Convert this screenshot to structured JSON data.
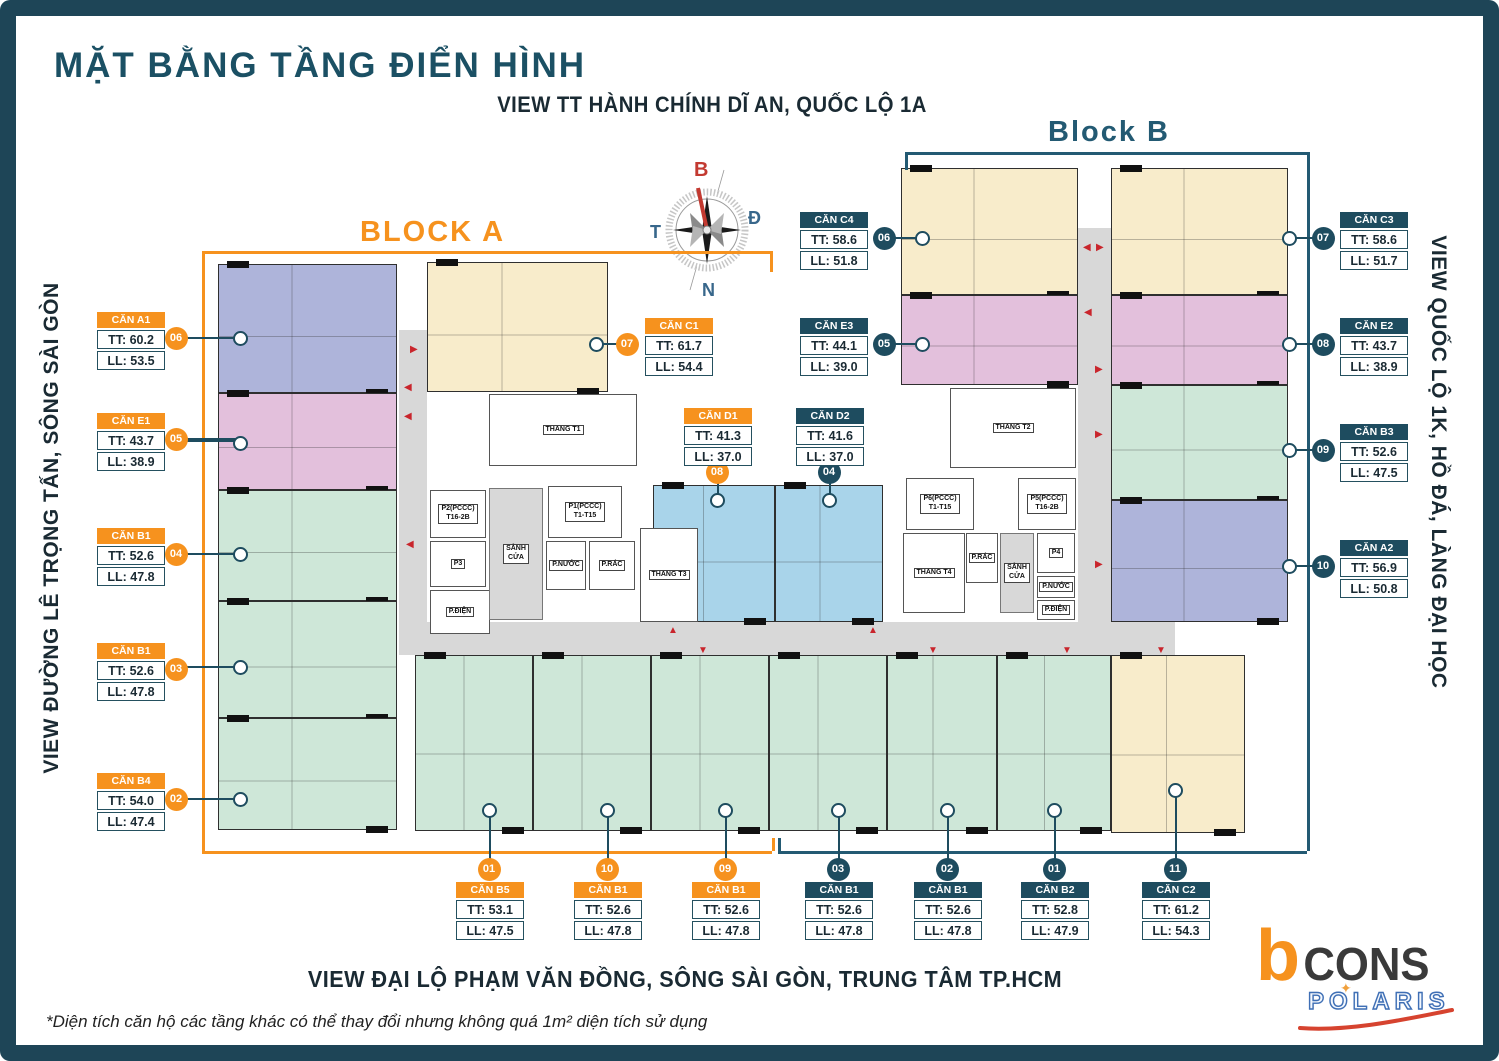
{
  "meta": {
    "title": "MẶT BẰNG TẦNG ĐIỂN HÌNH",
    "subtitle_top": "VIEW TT HÀNH CHÍNH DĨ AN, QUỐC LỘ 1A",
    "block_a": "BLOCK A",
    "block_b": "Block B",
    "view_left": "VIEW ĐƯỜNG LÊ TRỌNG TẤN, SÔNG SÀI GÒN",
    "view_right": "VIEW QUỐC LỘ 1K, HỒ ĐÁ, LÀNG ĐẠI HỌC",
    "view_bottom": "VIEW ĐẠI LỘ PHẠM VĂN ĐỒNG, SÔNG SÀI GÒN, TRUNG TÂM TP.HCM",
    "footnote": "*Diện tích căn hộ các tầng khác có thể thay đổi nhưng không quá 1m² diện tích sử dụng"
  },
  "compass": {
    "n": "B",
    "e": "Đ",
    "w": "T",
    "s": "N"
  },
  "logo": {
    "b": "b",
    "cons": "CONS",
    "polaris": "POLARIS",
    "star": "✦"
  },
  "palette": {
    "orange": "#F6921E",
    "teal": "#1E4C5F",
    "frame": "#1E4557",
    "purple": "#AEB4DA",
    "pink": "#E3C0DC",
    "green": "#CEE7D8",
    "cream": "#F8ECCB",
    "blue": "#A9D4EA",
    "corridor": "#D8D8D8",
    "red": "#C9252C"
  },
  "floorplan": {
    "units": [
      {
        "id": "A1",
        "type": "purple",
        "x": 218,
        "y": 264,
        "w": 179,
        "h": 129
      },
      {
        "id": "E1",
        "type": "pink",
        "x": 218,
        "y": 393,
        "w": 179,
        "h": 97
      },
      {
        "id": "B1-04",
        "type": "green",
        "x": 218,
        "y": 490,
        "w": 179,
        "h": 111
      },
      {
        "id": "B1-03",
        "type": "green",
        "x": 218,
        "y": 601,
        "w": 179,
        "h": 117
      },
      {
        "id": "B4-02",
        "type": "green",
        "x": 218,
        "y": 718,
        "w": 179,
        "h": 112
      },
      {
        "id": "C1",
        "type": "cream",
        "x": 427,
        "y": 262,
        "w": 181,
        "h": 130
      },
      {
        "id": "D1",
        "type": "blue",
        "x": 653,
        "y": 485,
        "w": 122,
        "h": 137
      },
      {
        "id": "D2",
        "type": "blue",
        "x": 775,
        "y": 485,
        "w": 108,
        "h": 137
      },
      {
        "id": "C4",
        "type": "cream",
        "x": 901,
        "y": 168,
        "w": 177,
        "h": 127
      },
      {
        "id": "C3",
        "type": "cream",
        "x": 1111,
        "y": 168,
        "w": 177,
        "h": 127
      },
      {
        "id": "E3",
        "type": "pink",
        "x": 901,
        "y": 295,
        "w": 177,
        "h": 90
      },
      {
        "id": "E2",
        "type": "pink",
        "x": 1111,
        "y": 295,
        "w": 177,
        "h": 90
      },
      {
        "id": "B3",
        "type": "green",
        "x": 1111,
        "y": 385,
        "w": 177,
        "h": 115
      },
      {
        "id": "A2",
        "type": "purple",
        "x": 1111,
        "y": 500,
        "w": 177,
        "h": 122
      },
      {
        "id": "B5",
        "type": "green",
        "x": 415,
        "y": 655,
        "w": 118,
        "h": 176
      },
      {
        "id": "B1-10",
        "type": "green",
        "x": 533,
        "y": 655,
        "w": 118,
        "h": 176
      },
      {
        "id": "B1-09",
        "type": "green",
        "x": 651,
        "y": 655,
        "w": 118,
        "h": 176
      },
      {
        "id": "B1-03b",
        "type": "green",
        "x": 769,
        "y": 655,
        "w": 118,
        "h": 176
      },
      {
        "id": "B1-02b",
        "type": "green",
        "x": 887,
        "y": 655,
        "w": 110,
        "h": 176
      },
      {
        "id": "B2",
        "type": "green",
        "x": 997,
        "y": 655,
        "w": 114,
        "h": 176
      },
      {
        "id": "C2",
        "type": "cream",
        "x": 1111,
        "y": 655,
        "w": 134,
        "h": 178
      }
    ],
    "corridors": [
      {
        "x": 399,
        "y": 330,
        "w": 28,
        "h": 325
      },
      {
        "x": 1078,
        "y": 228,
        "w": 33,
        "h": 427
      },
      {
        "x": 399,
        "y": 622,
        "w": 776,
        "h": 33
      }
    ],
    "rooms": [
      {
        "k": "stairs",
        "x": 489,
        "y": 394,
        "w": 148,
        "h": 72,
        "label": "THANG T1"
      },
      {
        "k": "lift",
        "x": 430,
        "y": 490,
        "w": 56,
        "h": 48,
        "label": "P2(PCCC)\nT16-2B"
      },
      {
        "k": "lift",
        "x": 548,
        "y": 486,
        "w": 74,
        "h": 52,
        "label": "P1(PCCC)\nT1-T15"
      },
      {
        "k": "lift",
        "x": 430,
        "y": 541,
        "w": 56,
        "h": 46,
        "label": "P3"
      },
      {
        "k": "room",
        "x": 430,
        "y": 590,
        "w": 60,
        "h": 44,
        "label": "P.ĐIỆN"
      },
      {
        "k": "lobby",
        "x": 489,
        "y": 488,
        "w": 54,
        "h": 132,
        "label": "SẢNH\nCỬA"
      },
      {
        "k": "room",
        "x": 546,
        "y": 541,
        "w": 40,
        "h": 49,
        "label": "P.NƯỚC"
      },
      {
        "k": "room",
        "x": 589,
        "y": 541,
        "w": 46,
        "h": 49,
        "label": "P.RÁC"
      },
      {
        "k": "stairs",
        "x": 640,
        "y": 528,
        "w": 58,
        "h": 94,
        "label": "THANG T3"
      },
      {
        "k": "stairs",
        "x": 950,
        "y": 388,
        "w": 126,
        "h": 80,
        "label": "THANG T2"
      },
      {
        "k": "lift",
        "x": 906,
        "y": 478,
        "w": 68,
        "h": 52,
        "label": "P6(PCCC)\nT1-T15"
      },
      {
        "k": "lift",
        "x": 1018,
        "y": 478,
        "w": 58,
        "h": 52,
        "label": "P5(PCCC)\nT16-2B"
      },
      {
        "k": "stairs",
        "x": 903,
        "y": 533,
        "w": 62,
        "h": 80,
        "label": "THANG T4"
      },
      {
        "k": "room",
        "x": 966,
        "y": 533,
        "w": 32,
        "h": 50,
        "label": "P.RÁC"
      },
      {
        "k": "lobby",
        "x": 1000,
        "y": 533,
        "w": 34,
        "h": 80,
        "label": "SẢNH\nCỬA"
      },
      {
        "k": "room",
        "x": 1037,
        "y": 533,
        "w": 38,
        "h": 40,
        "label": "P4"
      },
      {
        "k": "room",
        "x": 1037,
        "y": 576,
        "w": 38,
        "h": 22,
        "label": "P.NƯỚC"
      },
      {
        "k": "room",
        "x": 1037,
        "y": 600,
        "w": 38,
        "h": 20,
        "label": "P.ĐIỆN"
      }
    ],
    "arrows": [
      [
        410,
        345,
        "▶"
      ],
      [
        404,
        383,
        "◀"
      ],
      [
        404,
        412,
        "◀"
      ],
      [
        406,
        540,
        "◀"
      ],
      [
        1083,
        243,
        "◀"
      ],
      [
        1096,
        243,
        "▶"
      ],
      [
        1084,
        308,
        "◀"
      ],
      [
        1095,
        365,
        "▶"
      ],
      [
        1095,
        430,
        "▶"
      ],
      [
        1095,
        560,
        "▶"
      ],
      [
        668,
        626,
        "▲"
      ],
      [
        868,
        626,
        "▲"
      ],
      [
        698,
        646,
        "▼"
      ],
      [
        928,
        646,
        "▼"
      ],
      [
        1062,
        646,
        "▼"
      ],
      [
        1156,
        646,
        "▼"
      ]
    ],
    "brackets": [
      {
        "color": "#F6921E",
        "segs": [
          [
            202,
            251,
            770,
            251
          ],
          [
            770,
            251,
            770,
            272
          ],
          [
            202,
            251,
            202,
            851
          ],
          [
            202,
            851,
            772,
            851
          ],
          [
            772,
            838,
            772,
            851
          ]
        ]
      },
      {
        "color": "#235A73",
        "segs": [
          [
            905,
            152,
            1307,
            152
          ],
          [
            905,
            152,
            905,
            170
          ],
          [
            1307,
            152,
            1307,
            851
          ],
          [
            778,
            851,
            1307,
            851
          ],
          [
            778,
            838,
            778,
            851
          ]
        ]
      }
    ]
  },
  "callouts": [
    {
      "name": "CĂN A1",
      "tt": "TT: 60.2",
      "ll": "LL: 53.5",
      "badge": "06",
      "scheme": "orange",
      "box": [
        97,
        312
      ],
      "badge_c": [
        176,
        338
      ],
      "marker": [
        240,
        338
      ]
    },
    {
      "name": "CĂN E1",
      "tt": "TT: 43.7",
      "ll": "LL: 38.9",
      "badge": "05",
      "scheme": "orange",
      "box": [
        97,
        413
      ],
      "badge_c": [
        176,
        439
      ],
      "marker": [
        240,
        443
      ]
    },
    {
      "name": "CĂN B1",
      "tt": "TT: 52.6",
      "ll": "LL: 47.8",
      "badge": "04",
      "scheme": "orange",
      "box": [
        97,
        528
      ],
      "badge_c": [
        176,
        554
      ],
      "marker": [
        240,
        554
      ]
    },
    {
      "name": "CĂN B1",
      "tt": "TT: 52.6",
      "ll": "LL: 47.8",
      "badge": "03",
      "scheme": "orange",
      "box": [
        97,
        643
      ],
      "badge_c": [
        176,
        669
      ],
      "marker": [
        240,
        667
      ]
    },
    {
      "name": "CĂN B4",
      "tt": "TT: 54.0",
      "ll": "LL: 47.4",
      "badge": "02",
      "scheme": "orange",
      "box": [
        97,
        773
      ],
      "badge_c": [
        176,
        799
      ],
      "marker": [
        240,
        799
      ]
    },
    {
      "name": "CĂN C1",
      "tt": "TT: 61.7",
      "ll": "LL: 54.4",
      "badge": "07",
      "scheme": "orange",
      "box": [
        645,
        318
      ],
      "badge_c": [
        627,
        344
      ],
      "marker": [
        596,
        344
      ]
    },
    {
      "name": "CĂN C4",
      "tt": "TT: 58.6",
      "ll": "LL: 51.8",
      "badge": "06",
      "scheme": "teal",
      "box": [
        800,
        212
      ],
      "badge_c": [
        884,
        238
      ],
      "marker": [
        922,
        238
      ]
    },
    {
      "name": "CĂN E3",
      "tt": "TT: 44.1",
      "ll": "LL: 39.0",
      "badge": "05",
      "scheme": "teal",
      "box": [
        800,
        318
      ],
      "badge_c": [
        884,
        344
      ],
      "marker": [
        922,
        344
      ]
    },
    {
      "name": "CĂN D1",
      "tt": "TT: 41.3",
      "ll": "LL: 37.0",
      "badge": "08",
      "scheme": "orange",
      "box": [
        684,
        408
      ],
      "badge_c": [
        717,
        472
      ],
      "marker": [
        717,
        500
      ]
    },
    {
      "name": "CĂN D2",
      "tt": "TT: 41.6",
      "ll": "LL: 37.0",
      "badge": "04",
      "scheme": "teal",
      "box": [
        796,
        408
      ],
      "badge_c": [
        829,
        472
      ],
      "marker": [
        829,
        500
      ]
    },
    {
      "name": "CĂN C3",
      "tt": "TT: 58.6",
      "ll": "LL: 51.7",
      "badge": "07",
      "scheme": "teal",
      "box": [
        1340,
        212
      ],
      "badge_c": [
        1323,
        238
      ],
      "marker": [
        1289,
        238
      ]
    },
    {
      "name": "CĂN E2",
      "tt": "TT: 43.7",
      "ll": "LL: 38.9",
      "badge": "08",
      "scheme": "teal",
      "box": [
        1340,
        318
      ],
      "badge_c": [
        1323,
        344
      ],
      "marker": [
        1289,
        344
      ]
    },
    {
      "name": "CĂN B3",
      "tt": "TT: 52.6",
      "ll": "LL: 47.5",
      "badge": "09",
      "scheme": "teal",
      "box": [
        1340,
        424
      ],
      "badge_c": [
        1323,
        450
      ],
      "marker": [
        1289,
        450
      ]
    },
    {
      "name": "CĂN A2",
      "tt": "TT: 56.9",
      "ll": "LL: 50.8",
      "badge": "10",
      "scheme": "teal",
      "box": [
        1340,
        540
      ],
      "badge_c": [
        1323,
        566
      ],
      "marker": [
        1289,
        566
      ]
    },
    {
      "name": "CĂN B5",
      "tt": "TT: 53.1",
      "ll": "LL: 47.5",
      "badge": "01",
      "scheme": "orange",
      "box": [
        456,
        882
      ],
      "badge_c": [
        489,
        869
      ],
      "marker": [
        489,
        810
      ]
    },
    {
      "name": "CĂN B1",
      "tt": "TT: 52.6",
      "ll": "LL: 47.8",
      "badge": "10",
      "scheme": "orange",
      "box": [
        574,
        882
      ],
      "badge_c": [
        607,
        869
      ],
      "marker": [
        607,
        810
      ]
    },
    {
      "name": "CĂN B1",
      "tt": "TT: 52.6",
      "ll": "LL: 47.8",
      "badge": "09",
      "scheme": "orange",
      "box": [
        692,
        882
      ],
      "badge_c": [
        725,
        869
      ],
      "marker": [
        725,
        810
      ]
    },
    {
      "name": "CĂN B1",
      "tt": "TT: 52.6",
      "ll": "LL: 47.8",
      "badge": "03",
      "scheme": "teal",
      "box": [
        805,
        882
      ],
      "badge_c": [
        838,
        869
      ],
      "marker": [
        838,
        810
      ]
    },
    {
      "name": "CĂN B1",
      "tt": "TT: 52.6",
      "ll": "LL: 47.8",
      "badge": "02",
      "scheme": "teal",
      "box": [
        914,
        882
      ],
      "badge_c": [
        947,
        869
      ],
      "marker": [
        947,
        810
      ]
    },
    {
      "name": "CĂN B2",
      "tt": "TT: 52.8",
      "ll": "LL: 47.9",
      "badge": "01",
      "scheme": "teal",
      "box": [
        1021,
        882
      ],
      "badge_c": [
        1054,
        869
      ],
      "marker": [
        1054,
        810
      ]
    },
    {
      "name": "CĂN C2",
      "tt": "TT: 61.2",
      "ll": "LL: 54.3",
      "badge": "11",
      "scheme": "teal",
      "box": [
        1142,
        882
      ],
      "badge_c": [
        1175,
        869
      ],
      "marker": [
        1175,
        790
      ]
    }
  ]
}
